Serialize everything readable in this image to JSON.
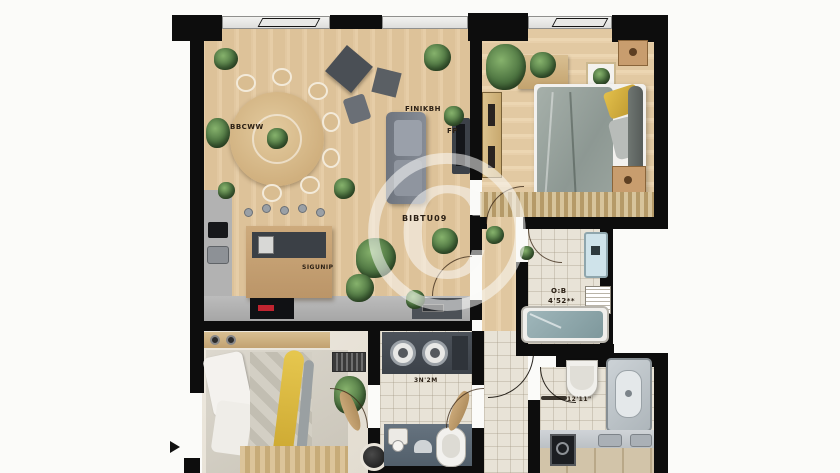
{
  "title": "apartment-floor-plan",
  "watermark": {
    "symbol": "©",
    "code": "BIBTU09"
  },
  "labels": {
    "dining": "BBCWW",
    "sofa_area": "FINIKBH",
    "fp": "FP",
    "kitchen": "SIGUNIP",
    "bath_tub_name": "O:B",
    "bath_tub_dim": "4'52**",
    "laundry_dim": "3N'2M",
    "bathroom_dim": "12'11\""
  },
  "palette": {
    "wall": "#0d0d0d",
    "wood_light": "#e2c9a3",
    "tile": "#e8e3d7",
    "pale_floor": "#eae5da",
    "sofa_gray": "#7d838c",
    "counter_gray": "#b2b2b2",
    "island_top": "#3b4046",
    "accent_yellow": "#d9b33c",
    "tub_teal": "#8fa9ad",
    "plant_green": "#4c7340",
    "heater_blue": "#cfe3ea",
    "mat_blue": "#5d6b77"
  },
  "rooms": [
    "living-dining-room",
    "kitchen",
    "bedroom-top-right",
    "bathroom-with-tub",
    "bedroom-bottom-left",
    "laundry-wc",
    "corridor",
    "bathroom-bottom-right"
  ]
}
